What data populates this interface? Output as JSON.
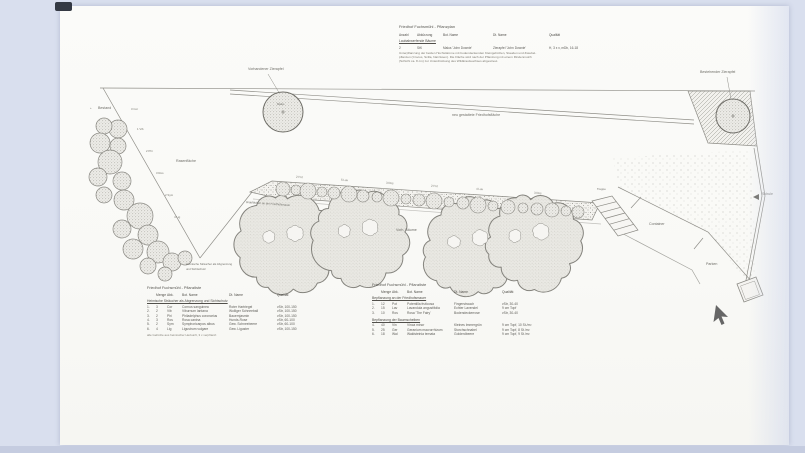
{
  "colors": {
    "page_bg": "#d9dfee",
    "bottom_bar": "#c5cce0",
    "sheet": "#fbfbf9",
    "ink": "#6e6d67",
    "line": "#8f8e88"
  },
  "header_block": {
    "title": "Friedhof Fuchsmühl - Pflanzplan",
    "columns": [
      "Anzahl",
      "Abkürzung",
      "Bot. Name",
      "Dt. Name",
      "Qualität"
    ],
    "section": "Laubabwerfende Bäume",
    "row": {
      "nr": "2",
      "abk": "StK",
      "bot": "Malus 'John Downie'",
      "dt": "Zierapfel 'John Downie'",
      "qual": "H, 3 x v, mDb, 16-18"
    },
    "note_lines": [
      "Unterpflanzung der beiden Hochstämme mit bodendeckenden Kleingehölzen, Stauden und Zwiebel-",
      "pflanzen (Crocus, Scilla, Narzissen). Die Fläche wird nach der Pflanzung mit einem Rindenmulch",
      "(Schicht ca. 8 cm) zur Unterdrückung des Wildkrautwuchses abgestreut."
    ]
  },
  "plan": {
    "labels": {
      "plus_mark": "+",
      "bestand": "Bestand",
      "rasenflaeche": "Rasenfläche",
      "vorh_zierapfel": "Vorhandener Zierapfel",
      "best_zierapfel": "Bestehender Zierapfel",
      "malus": "Malus",
      "neu_flaeche": "neu gestaltete Friedhofsfläche",
      "grabflaechen": "Grabflächen an der Friedhofsmauer",
      "vorh_baeume": "Vorh. Bäume",
      "treppe": "Treppe",
      "container": "Container",
      "parken": "Parken",
      "schule": "Schule",
      "sichtschutz_1": "Heimische Sträucher als Abgrenzung",
      "sichtschutz_2": "und Sichtschutz"
    },
    "left_row_ticks": [
      "3 Cor",
      "1 Vib",
      "2 Phi",
      "3 Ros",
      "2 Sym",
      "4 Lig"
    ],
    "strip_ticks": [
      "2 Pot",
      "5 Lav",
      "3 Ros",
      "2 Pot",
      "4 Lav",
      "3 Ros"
    ]
  },
  "table_left": {
    "title": "Friedhof Fuchsmühl - Pflanzliste",
    "columns": [
      "Menge",
      "Abk.",
      "Bot. Name",
      "Dt. Name",
      "Qualität"
    ],
    "section": "Heimische Sträucher als Abgrenzung und Sichtschutz",
    "rows": [
      {
        "nr": "1.",
        "menge": "3",
        "abk": "Cor",
        "bot": "Cornus sanguinea",
        "dt": "Roter Hartriegel",
        "qual": "vStr, 100-150"
      },
      {
        "nr": "2.",
        "menge": "2",
        "abk": "Vib",
        "bot": "Viburnum lantana",
        "dt": "Wolliger Schneeball",
        "qual": "vStr, 100-150"
      },
      {
        "nr": "3.",
        "menge": "2",
        "abk": "Phi",
        "bot": "Philadelphus coronarius",
        "dt": "Bauernjasmin",
        "qual": "vStr, 100-150"
      },
      {
        "nr": "4.",
        "menge": "3",
        "abk": "Ros",
        "bot": "Rosa canina",
        "dt": "Hunds-Rose",
        "qual": "vStr, 60-100"
      },
      {
        "nr": "5.",
        "menge": "2",
        "abk": "Sym",
        "bot": "Symphoricarpos albus",
        "dt": "Gew. Schneebeere",
        "qual": "vStr, 60-100"
      },
      {
        "nr": "6.",
        "menge": "4",
        "abk": "Lig",
        "bot": "Ligustrum vulgare",
        "dt": "Gew. Liguster",
        "qual": "vStr, 100-150"
      }
    ],
    "note": "alle Gehölze aus heimischer Herkunft, 3 x verpflanzt"
  },
  "table_right": {
    "title": "Friedhof Fuchsmühl - Pflanzliste",
    "columns": [
      "Menge",
      "Abk.",
      "Bot. Name",
      "Dt. Name",
      "Qualität"
    ],
    "section1": "Bepflanzung an der Friedhofsmauer",
    "rows1": [
      {
        "nr": "1.",
        "menge": "12",
        "abk": "Pot",
        "bot": "Potentilla fruticosa",
        "dt": "Fingerstrauch",
        "qual": "vStr, 30-40"
      },
      {
        "nr": "2.",
        "menge": "15",
        "abk": "Lav",
        "bot": "Lavandula angustifolia",
        "dt": "Echter Lavendel",
        "qual": "9 cm Topf"
      },
      {
        "nr": "3.",
        "menge": "10",
        "abk": "Ros",
        "bot": "Rosa 'The Fairy'",
        "dt": "Bodendeckerrose",
        "qual": "vStr, 30-40"
      }
    ],
    "section2": "Bepflanzung der Baumscheiben",
    "rows2": [
      {
        "nr": "4.",
        "menge": "40",
        "abk": "Vin",
        "bot": "Vinca minor",
        "dt": "Kleines Immergrün",
        "qual": "9 cm Topf, 10 St./m²"
      },
      {
        "nr": "5.",
        "menge": "25",
        "abk": "Ger",
        "bot": "Geranium macrorrhizum",
        "dt": "Storchschnabel",
        "qual": "9 cm Topf, 8 St./m²"
      },
      {
        "nr": "6.",
        "menge": "18",
        "abk": "Wal",
        "bot": "Waldsteinia ternata",
        "dt": "Golderdbeere",
        "qual": "9 cm Topf, 9 St./m²"
      }
    ]
  }
}
